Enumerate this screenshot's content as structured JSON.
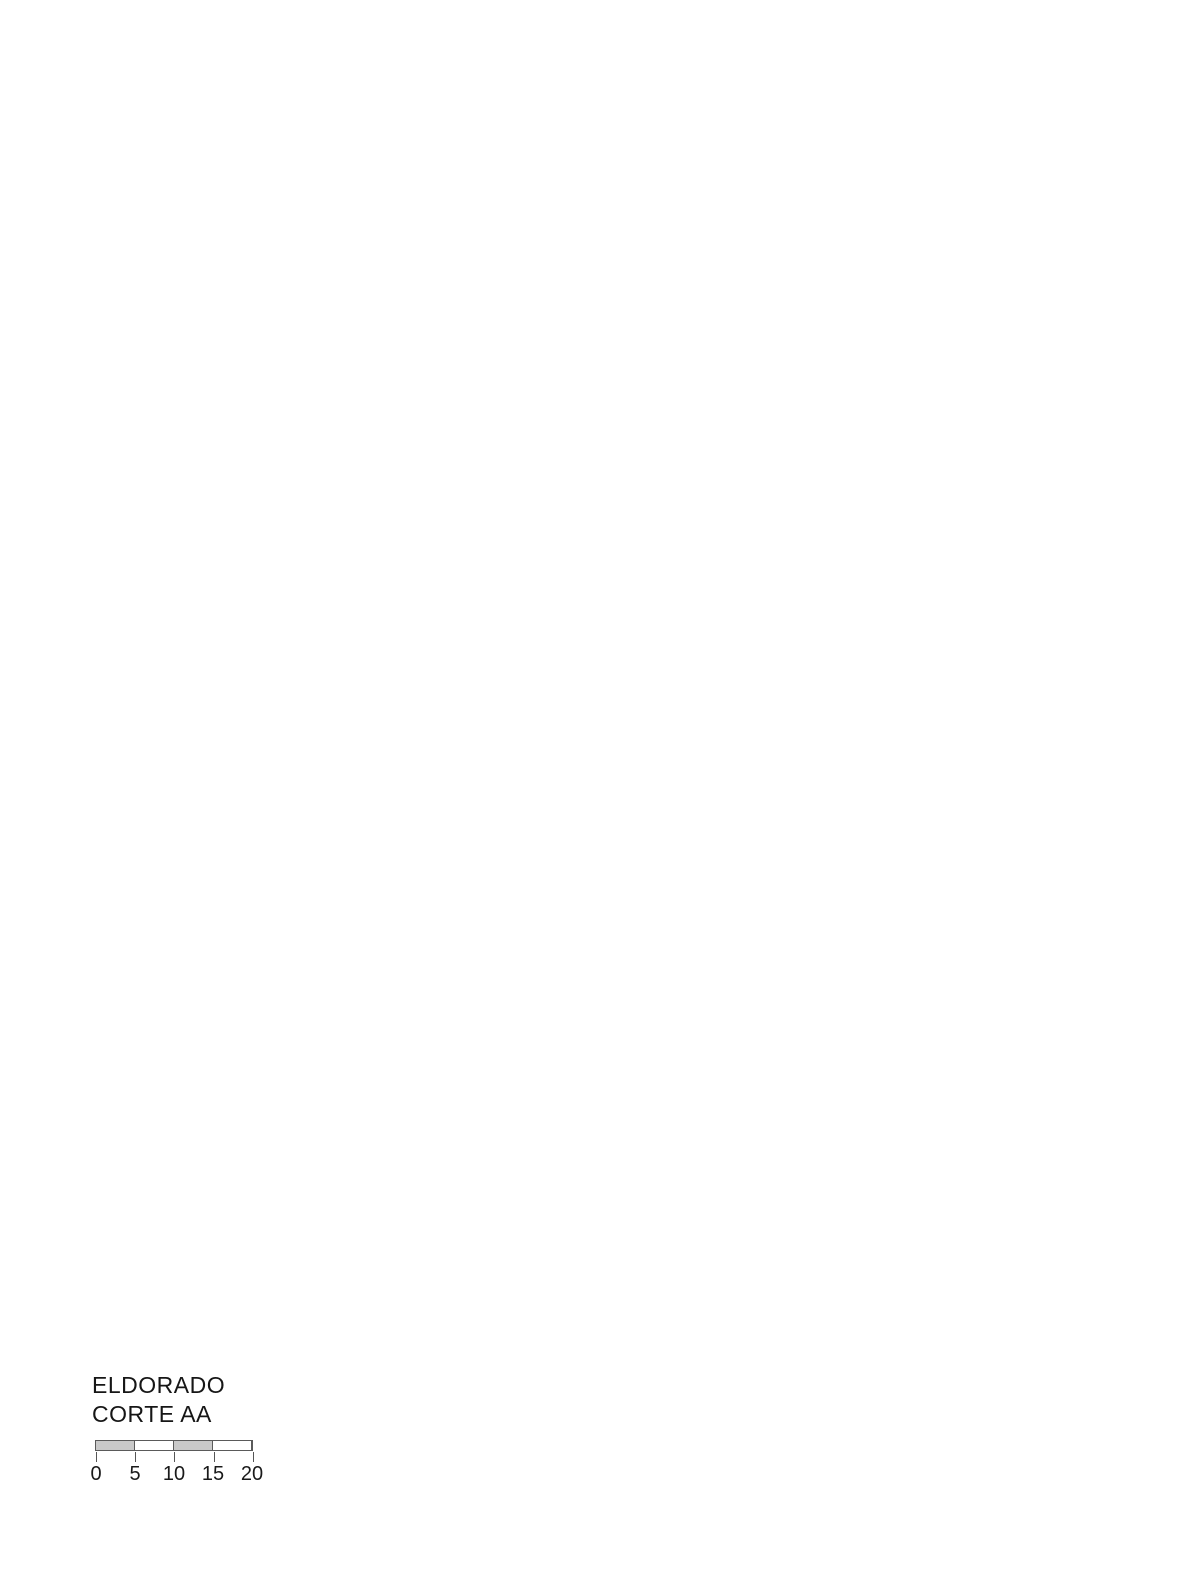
{
  "title_block": {
    "project": "ELDORADO",
    "view": "CORTE AA"
  },
  "scale_bar": {
    "labels": [
      "0",
      "5",
      "10",
      "15",
      "20"
    ]
  },
  "drawing": {
    "typical_floors": 33,
    "floor_pitch_px": 29,
    "floors_start_y": 160,
    "basement_slabs_y": [
      1233,
      1257,
      1281
    ],
    "annex_slabs_y": [
      1127,
      1170,
      1202,
      1234
    ],
    "stair_tower_levels": 8,
    "colors": {
      "ink": "#2a2a2a",
      "slab": "#8a8a8a",
      "light": "#c4c4c4",
      "red_marker": "#e03038",
      "blue_marker": "#4da3f0",
      "screen_gray": "#cdcdcd",
      "paper": "#ffffff"
    }
  }
}
